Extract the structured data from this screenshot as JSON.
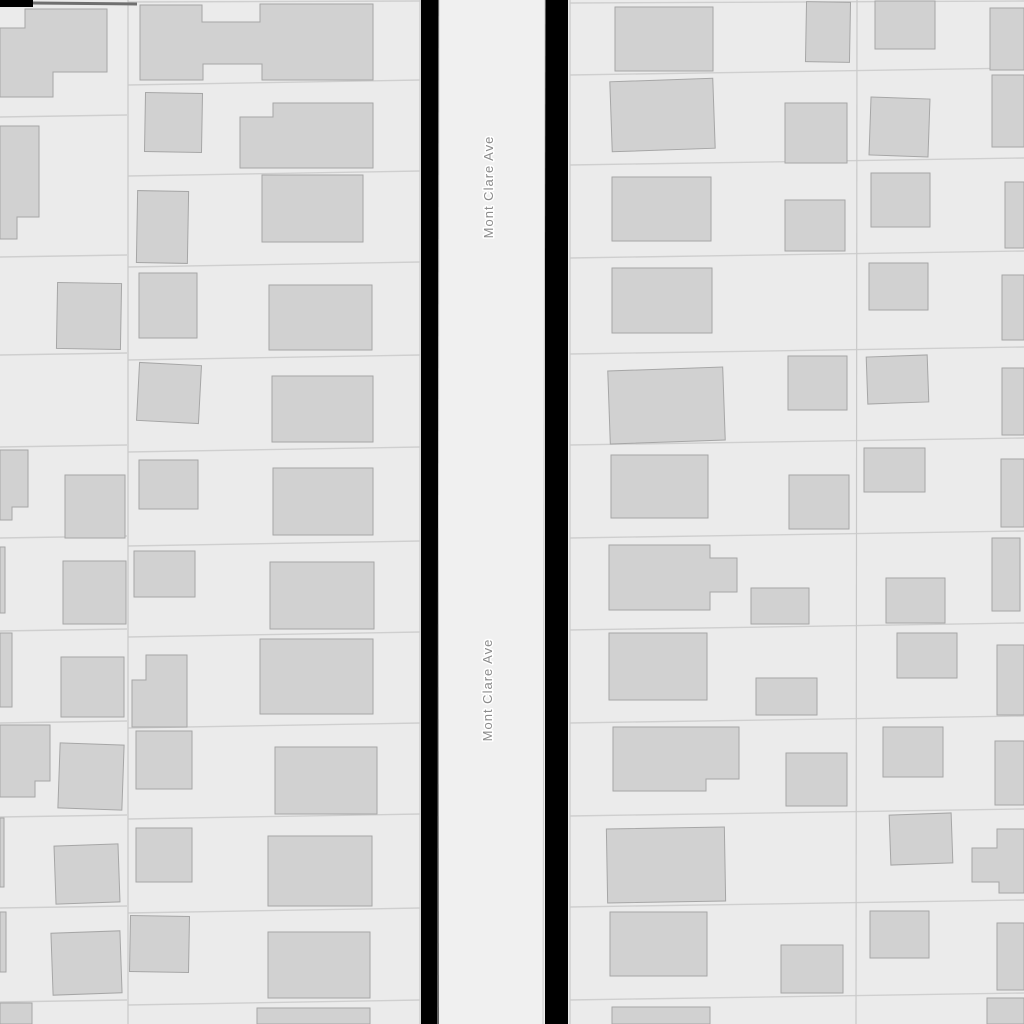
{
  "map": {
    "width": 1024,
    "height": 1024,
    "colors": {
      "background": "#ebebeb",
      "building_fill": "#d1d1d1",
      "building_stroke": "#a6a6a6",
      "parcel_line": "#cfcfcf",
      "divider_line": "#c9c9c9",
      "street_fill": "#f0f0f0",
      "street_casing": "#c9c9c9",
      "road_gap": "#000000",
      "label": "#8b8b8b",
      "top_accent": "#6f6f6f"
    },
    "street": {
      "name": "Mont Clare Ave",
      "x1": 439,
      "x2": 545,
      "labels": [
        {
          "x": 493,
          "y": 187
        },
        {
          "x": 492,
          "y": 690
        }
      ]
    },
    "road_gaps": [
      {
        "x": 421,
        "y": 0,
        "w": 18,
        "h": 1024
      },
      {
        "x": 545,
        "y": 0,
        "w": 23,
        "h": 1024
      },
      {
        "x": 0,
        "y": 0,
        "w": 33,
        "h": 7
      }
    ],
    "top_accent_line": {
      "x1": 33,
      "y1": 3,
      "x2": 137,
      "y2": 4
    },
    "dividers": [
      {
        "x1": 128,
        "y1": 0,
        "x2": 128,
        "y2": 1024
      },
      {
        "x1": 420,
        "y1": 0,
        "x2": 420,
        "y2": 1024
      },
      {
        "x1": 570,
        "y1": 0,
        "x2": 570,
        "y2": 1024
      },
      {
        "x1": 857,
        "y1": 0,
        "x2": 856,
        "y2": 1024
      }
    ],
    "parcel_lines": [
      {
        "x1": 0,
        "y1": 117,
        "x2": 127,
        "y2": 115
      },
      {
        "x1": 0,
        "y1": 257,
        "x2": 127,
        "y2": 255
      },
      {
        "x1": 0,
        "y1": 355,
        "x2": 127,
        "y2": 353
      },
      {
        "x1": 0,
        "y1": 447,
        "x2": 127,
        "y2": 445
      },
      {
        "x1": 0,
        "y1": 538,
        "x2": 127,
        "y2": 536
      },
      {
        "x1": 0,
        "y1": 631,
        "x2": 127,
        "y2": 629
      },
      {
        "x1": 0,
        "y1": 723,
        "x2": 127,
        "y2": 721
      },
      {
        "x1": 0,
        "y1": 817,
        "x2": 127,
        "y2": 815
      },
      {
        "x1": 0,
        "y1": 908,
        "x2": 127,
        "y2": 906
      },
      {
        "x1": 0,
        "y1": 1002,
        "x2": 127,
        "y2": 1000
      },
      {
        "x1": 128,
        "y1": 2,
        "x2": 420,
        "y2": 1
      },
      {
        "x1": 128,
        "y1": 85,
        "x2": 420,
        "y2": 80
      },
      {
        "x1": 128,
        "y1": 176,
        "x2": 420,
        "y2": 171
      },
      {
        "x1": 128,
        "y1": 267,
        "x2": 420,
        "y2": 262
      },
      {
        "x1": 128,
        "y1": 360,
        "x2": 420,
        "y2": 355
      },
      {
        "x1": 128,
        "y1": 452,
        "x2": 420,
        "y2": 447
      },
      {
        "x1": 128,
        "y1": 546,
        "x2": 420,
        "y2": 541
      },
      {
        "x1": 128,
        "y1": 637,
        "x2": 420,
        "y2": 632
      },
      {
        "x1": 128,
        "y1": 728,
        "x2": 420,
        "y2": 723
      },
      {
        "x1": 128,
        "y1": 819,
        "x2": 420,
        "y2": 814
      },
      {
        "x1": 128,
        "y1": 913,
        "x2": 420,
        "y2": 908
      },
      {
        "x1": 128,
        "y1": 1005,
        "x2": 420,
        "y2": 1000
      },
      {
        "x1": 570,
        "y1": 3,
        "x2": 1024,
        "y2": 1
      },
      {
        "x1": 570,
        "y1": 75,
        "x2": 1024,
        "y2": 68
      },
      {
        "x1": 570,
        "y1": 165,
        "x2": 1024,
        "y2": 158
      },
      {
        "x1": 570,
        "y1": 258,
        "x2": 1024,
        "y2": 251
      },
      {
        "x1": 570,
        "y1": 354,
        "x2": 1024,
        "y2": 347
      },
      {
        "x1": 570,
        "y1": 445,
        "x2": 1024,
        "y2": 438
      },
      {
        "x1": 570,
        "y1": 538,
        "x2": 1024,
        "y2": 531
      },
      {
        "x1": 570,
        "y1": 630,
        "x2": 1024,
        "y2": 623
      },
      {
        "x1": 570,
        "y1": 723,
        "x2": 1024,
        "y2": 716
      },
      {
        "x1": 570,
        "y1": 816,
        "x2": 1024,
        "y2": 809
      },
      {
        "x1": 570,
        "y1": 907,
        "x2": 1024,
        "y2": 900
      },
      {
        "x1": 570,
        "y1": 1000,
        "x2": 1024,
        "y2": 993
      }
    ],
    "buildings": [
      {
        "type": "poly",
        "points": [
          [
            25,
            9
          ],
          [
            107,
            9
          ],
          [
            107,
            72
          ],
          [
            53,
            72
          ],
          [
            53,
            97
          ],
          [
            0,
            97
          ],
          [
            0,
            28
          ],
          [
            25,
            28
          ]
        ]
      },
      {
        "type": "poly",
        "points": [
          [
            0,
            126
          ],
          [
            39,
            126
          ],
          [
            39,
            217
          ],
          [
            17,
            217
          ],
          [
            17,
            239
          ],
          [
            0,
            239
          ]
        ]
      },
      {
        "type": "rect",
        "x": 57,
        "y": 283,
        "w": 64,
        "h": 66,
        "rot": 1
      },
      {
        "type": "poly",
        "points": [
          [
            0,
            450
          ],
          [
            28,
            450
          ],
          [
            28,
            507
          ],
          [
            12,
            507
          ],
          [
            12,
            520
          ],
          [
            0,
            520
          ]
        ]
      },
      {
        "type": "rect",
        "x": 65,
        "y": 475,
        "w": 60,
        "h": 63
      },
      {
        "type": "rect",
        "x": 0,
        "y": 547,
        "w": 5,
        "h": 66
      },
      {
        "type": "rect",
        "x": 63,
        "y": 561,
        "w": 63,
        "h": 63
      },
      {
        "type": "rect",
        "x": 0,
        "y": 633,
        "w": 12,
        "h": 74
      },
      {
        "type": "rect",
        "x": 61,
        "y": 657,
        "w": 63,
        "h": 60
      },
      {
        "type": "poly",
        "points": [
          [
            0,
            725
          ],
          [
            50,
            725
          ],
          [
            50,
            781
          ],
          [
            35,
            781
          ],
          [
            35,
            797
          ],
          [
            0,
            797
          ]
        ]
      },
      {
        "type": "rect",
        "x": 59,
        "y": 744,
        "w": 64,
        "h": 65,
        "rot": 2
      },
      {
        "type": "rect",
        "x": 0,
        "y": 818,
        "w": 4,
        "h": 69
      },
      {
        "type": "rect",
        "x": 55,
        "y": 845,
        "w": 64,
        "h": 58,
        "rot": -2
      },
      {
        "type": "rect",
        "x": 0,
        "y": 912,
        "w": 6,
        "h": 60
      },
      {
        "type": "rect",
        "x": 52,
        "y": 932,
        "w": 69,
        "h": 62,
        "rot": -2
      },
      {
        "type": "rect",
        "x": 0,
        "y": 1003,
        "w": 32,
        "h": 21
      },
      {
        "type": "poly",
        "points": [
          [
            140,
            5
          ],
          [
            202,
            5
          ],
          [
            202,
            22
          ],
          [
            260,
            22
          ],
          [
            260,
            4
          ],
          [
            373,
            4
          ],
          [
            373,
            80
          ],
          [
            262,
            80
          ],
          [
            262,
            64
          ],
          [
            203,
            64
          ],
          [
            203,
            80
          ],
          [
            140,
            80
          ]
        ]
      },
      {
        "type": "rect",
        "x": 145,
        "y": 93,
        "w": 57,
        "h": 59,
        "rot": 1
      },
      {
        "type": "poly",
        "points": [
          [
            240,
            117
          ],
          [
            273,
            117
          ],
          [
            273,
            103
          ],
          [
            373,
            103
          ],
          [
            373,
            168
          ],
          [
            240,
            168
          ]
        ]
      },
      {
        "type": "rect",
        "x": 137,
        "y": 191,
        "w": 51,
        "h": 72,
        "rot": 1
      },
      {
        "type": "rect",
        "x": 262,
        "y": 175,
        "w": 101,
        "h": 67
      },
      {
        "type": "rect",
        "x": 139,
        "y": 273,
        "w": 58,
        "h": 65
      },
      {
        "type": "rect",
        "x": 269,
        "y": 285,
        "w": 103,
        "h": 65
      },
      {
        "type": "rect",
        "x": 138,
        "y": 364,
        "w": 62,
        "h": 58,
        "rot": 3
      },
      {
        "type": "rect",
        "x": 272,
        "y": 376,
        "w": 101,
        "h": 66
      },
      {
        "type": "rect",
        "x": 139,
        "y": 460,
        "w": 59,
        "h": 49
      },
      {
        "type": "rect",
        "x": 273,
        "y": 468,
        "w": 100,
        "h": 67
      },
      {
        "type": "rect",
        "x": 134,
        "y": 551,
        "w": 61,
        "h": 46
      },
      {
        "type": "rect",
        "x": 270,
        "y": 562,
        "w": 104,
        "h": 67
      },
      {
        "type": "poly",
        "points": [
          [
            146,
            655
          ],
          [
            187,
            655
          ],
          [
            187,
            727
          ],
          [
            132,
            727
          ],
          [
            132,
            680
          ],
          [
            146,
            680
          ]
        ]
      },
      {
        "type": "rect",
        "x": 260,
        "y": 639,
        "w": 113,
        "h": 75
      },
      {
        "type": "rect",
        "x": 136,
        "y": 731,
        "w": 56,
        "h": 58
      },
      {
        "type": "rect",
        "x": 275,
        "y": 747,
        "w": 102,
        "h": 67
      },
      {
        "type": "rect",
        "x": 136,
        "y": 828,
        "w": 56,
        "h": 54
      },
      {
        "type": "rect",
        "x": 268,
        "y": 836,
        "w": 104,
        "h": 70
      },
      {
        "type": "rect",
        "x": 130,
        "y": 916,
        "w": 59,
        "h": 56,
        "rot": 1
      },
      {
        "type": "rect",
        "x": 268,
        "y": 932,
        "w": 102,
        "h": 66
      },
      {
        "type": "rect",
        "x": 257,
        "y": 1008,
        "w": 113,
        "h": 16
      },
      {
        "type": "rect",
        "x": 615,
        "y": 7,
        "w": 98,
        "h": 64
      },
      {
        "type": "rect",
        "x": 806,
        "y": 2,
        "w": 44,
        "h": 60,
        "rot": 1
      },
      {
        "type": "rect",
        "x": 611,
        "y": 80,
        "w": 103,
        "h": 70,
        "rot": -2
      },
      {
        "type": "rect",
        "x": 785,
        "y": 103,
        "w": 62,
        "h": 60
      },
      {
        "type": "rect",
        "x": 612,
        "y": 177,
        "w": 99,
        "h": 64
      },
      {
        "type": "rect",
        "x": 785,
        "y": 200,
        "w": 60,
        "h": 51
      },
      {
        "type": "rect",
        "x": 612,
        "y": 268,
        "w": 100,
        "h": 65
      },
      {
        "type": "rect",
        "x": 609,
        "y": 369,
        "w": 115,
        "h": 73,
        "rot": -2
      },
      {
        "type": "rect",
        "x": 788,
        "y": 356,
        "w": 59,
        "h": 54
      },
      {
        "type": "rect",
        "x": 611,
        "y": 455,
        "w": 97,
        "h": 63
      },
      {
        "type": "rect",
        "x": 789,
        "y": 475,
        "w": 60,
        "h": 54
      },
      {
        "type": "poly",
        "points": [
          [
            609,
            545
          ],
          [
            710,
            545
          ],
          [
            710,
            558
          ],
          [
            737,
            558
          ],
          [
            737,
            592
          ],
          [
            710,
            592
          ],
          [
            710,
            610
          ],
          [
            609,
            610
          ]
        ]
      },
      {
        "type": "rect",
        "x": 751,
        "y": 588,
        "w": 58,
        "h": 36
      },
      {
        "type": "rect",
        "x": 609,
        "y": 633,
        "w": 98,
        "h": 67
      },
      {
        "type": "rect",
        "x": 756,
        "y": 678,
        "w": 61,
        "h": 37
      },
      {
        "type": "poly",
        "points": [
          [
            613,
            727
          ],
          [
            739,
            727
          ],
          [
            739,
            779
          ],
          [
            706,
            779
          ],
          [
            706,
            791
          ],
          [
            613,
            791
          ]
        ]
      },
      {
        "type": "rect",
        "x": 786,
        "y": 753,
        "w": 61,
        "h": 53
      },
      {
        "type": "rect",
        "x": 607,
        "y": 828,
        "w": 118,
        "h": 74,
        "rot": -1
      },
      {
        "type": "rect",
        "x": 610,
        "y": 912,
        "w": 97,
        "h": 64
      },
      {
        "type": "rect",
        "x": 781,
        "y": 945,
        "w": 62,
        "h": 48
      },
      {
        "type": "rect",
        "x": 612,
        "y": 1007,
        "w": 98,
        "h": 17
      },
      {
        "type": "rect",
        "x": 875,
        "y": 1,
        "w": 60,
        "h": 48
      },
      {
        "type": "rect",
        "x": 990,
        "y": 8,
        "w": 34,
        "h": 62
      },
      {
        "type": "rect",
        "x": 870,
        "y": 98,
        "w": 59,
        "h": 58,
        "rot": 2
      },
      {
        "type": "rect",
        "x": 992,
        "y": 75,
        "w": 32,
        "h": 72
      },
      {
        "type": "rect",
        "x": 871,
        "y": 173,
        "w": 59,
        "h": 54
      },
      {
        "type": "rect",
        "x": 1005,
        "y": 182,
        "w": 19,
        "h": 66
      },
      {
        "type": "rect",
        "x": 869,
        "y": 263,
        "w": 59,
        "h": 47
      },
      {
        "type": "rect",
        "x": 1002,
        "y": 275,
        "w": 22,
        "h": 65
      },
      {
        "type": "rect",
        "x": 867,
        "y": 356,
        "w": 61,
        "h": 47,
        "rot": -2
      },
      {
        "type": "rect",
        "x": 1002,
        "y": 368,
        "w": 22,
        "h": 67
      },
      {
        "type": "rect",
        "x": 864,
        "y": 448,
        "w": 61,
        "h": 44
      },
      {
        "type": "rect",
        "x": 1001,
        "y": 459,
        "w": 23,
        "h": 68
      },
      {
        "type": "rect",
        "x": 886,
        "y": 578,
        "w": 59,
        "h": 45
      },
      {
        "type": "rect",
        "x": 992,
        "y": 538,
        "w": 28,
        "h": 73
      },
      {
        "type": "rect",
        "x": 897,
        "y": 633,
        "w": 60,
        "h": 45
      },
      {
        "type": "rect",
        "x": 997,
        "y": 645,
        "w": 27,
        "h": 70
      },
      {
        "type": "rect",
        "x": 883,
        "y": 727,
        "w": 60,
        "h": 50
      },
      {
        "type": "rect",
        "x": 995,
        "y": 741,
        "w": 29,
        "h": 64
      },
      {
        "type": "rect",
        "x": 890,
        "y": 814,
        "w": 62,
        "h": 50,
        "rot": -2
      },
      {
        "type": "poly",
        "points": [
          [
            972,
            848
          ],
          [
            997,
            848
          ],
          [
            997,
            829
          ],
          [
            1024,
            829
          ],
          [
            1024,
            893
          ],
          [
            999,
            893
          ],
          [
            999,
            882
          ],
          [
            972,
            882
          ]
        ]
      },
      {
        "type": "rect",
        "x": 870,
        "y": 911,
        "w": 59,
        "h": 47
      },
      {
        "type": "rect",
        "x": 997,
        "y": 923,
        "w": 27,
        "h": 67
      },
      {
        "type": "rect",
        "x": 987,
        "y": 998,
        "w": 37,
        "h": 26
      }
    ]
  }
}
